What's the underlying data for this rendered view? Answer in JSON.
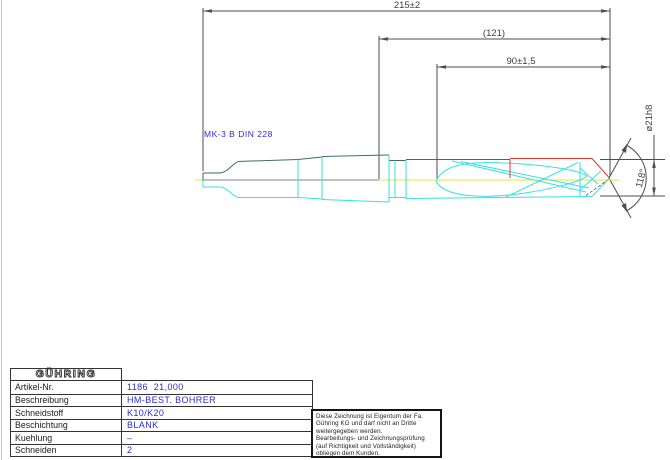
{
  "drawing": {
    "dimensions": {
      "overall_length": "215±2",
      "intermediate_length": "(121)",
      "flute_length": "90±1,5",
      "diameter": "ø21h8",
      "point_angle": "118°",
      "taper_label": "MK-3 B DIN 228"
    },
    "colors": {
      "edge_top": "#3d6b6b",
      "edge_cyan": "#35e2e2",
      "centerline_yellow": "#f0e52e",
      "centerline_gray": "#808080",
      "carbide_red": "#e0352b",
      "dim_line": "#4d4d4d",
      "label_blue": "#2b2bd5"
    }
  },
  "titleblock": {
    "logo": "GÜHRING",
    "rows": [
      {
        "label": "Artikel-Nr.",
        "value": "1186  21,000"
      },
      {
        "label": "Beschreibung",
        "value": "HM-BEST. BOHRER"
      },
      {
        "label": "Schneidstoff",
        "value": "K10/K20"
      },
      {
        "label": "Beschichtung",
        "value": "BLANK"
      },
      {
        "label": "Kuehlung",
        "value": "–"
      },
      {
        "label": "Schneiden",
        "value": "2"
      }
    ]
  },
  "notice": {
    "lines": [
      "Diese Zeichnung ist Eigentum der Fa.",
      "Gühring KG und darf nicht an Dritte",
      "weitergegeben werden.",
      "Bearbeitungs- und Zeichnungsprüfung",
      "(auf Richtigkeit und Vollständigkeit)",
      "obliegen dem Kunden."
    ]
  }
}
